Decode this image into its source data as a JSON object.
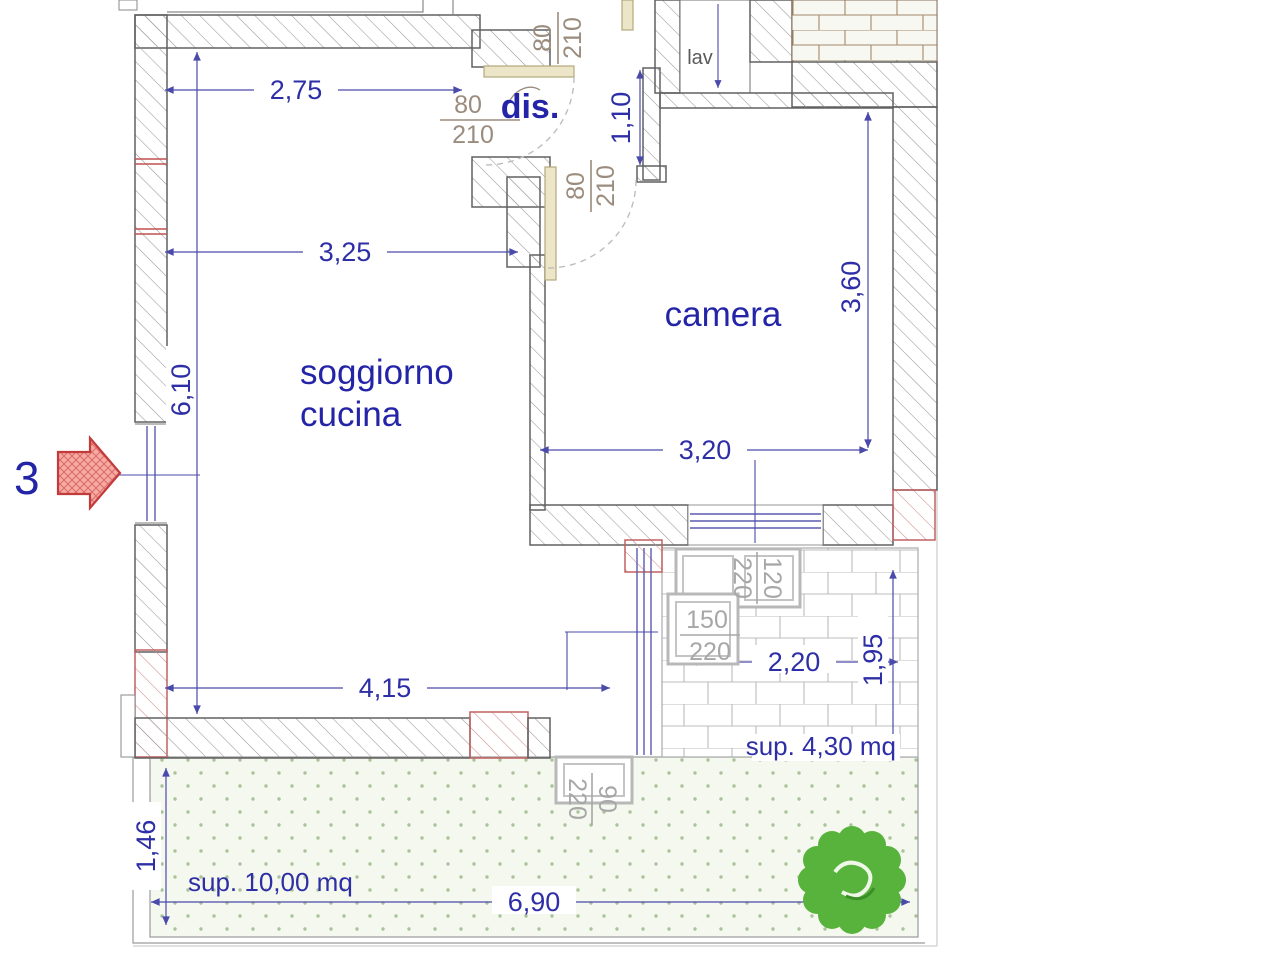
{
  "plan": {
    "unit_number": "3",
    "rooms": {
      "soggiorno": {
        "line1": "soggiorno",
        "line2": "cucina"
      },
      "camera": {
        "label": "camera"
      },
      "dis": {
        "label": "dis."
      },
      "lav": {
        "label": "lav"
      }
    },
    "areas": {
      "terrace": {
        "label": "sup. 4,30 mq"
      },
      "garden": {
        "label": "sup. 10,00 mq"
      }
    },
    "dimensions": {
      "soggiorno_top": "2,75",
      "soggiorno_mid": "3,25",
      "soggiorno_height": "6,10",
      "soggiorno_bottom": "4,15",
      "camera_width": "3,20",
      "camera_height": "3,60",
      "passage": "1,10",
      "terrace_width": "2,20",
      "terrace_height": "1,95",
      "garden_width": "6,90",
      "garden_height": "1,46"
    },
    "openings": {
      "door_soggiorno_dis": {
        "num": "80",
        "den": "210"
      },
      "door_dis_top": {
        "num": "80",
        "den": "210"
      },
      "door_camera": {
        "num": "80",
        "den": "210"
      },
      "window_terrace": {
        "num": "120",
        "den": "220"
      },
      "door_terrace": {
        "num": "150",
        "den": "220"
      },
      "door_garden": {
        "num": "90",
        "den": "220"
      }
    },
    "colors": {
      "dimension_blue": "#2e2ea6",
      "room_label_blue": "#2424a8",
      "door_label_brown": "#9b8c7e",
      "door_label_grey": "#a7a7a7",
      "wall_outline": "#606060",
      "red_accent": "#c0392b",
      "door_leaf_beige": "#ece5c7",
      "garden_green": "#f3f7ea",
      "bush_green": "#57b33b"
    }
  }
}
